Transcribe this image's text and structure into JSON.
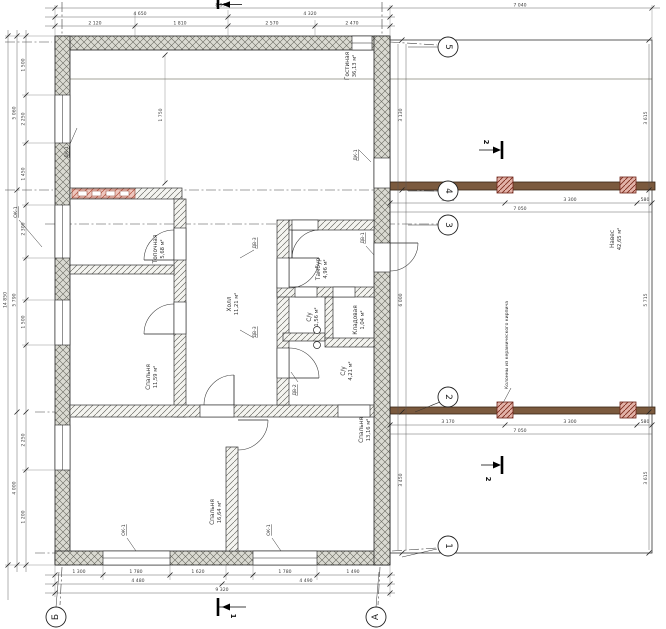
{
  "title": "План дома",
  "rooms": [
    {
      "name": "Гостиная",
      "area": "36,13 м²"
    },
    {
      "name": "Топочная",
      "area": "5,68 м²"
    },
    {
      "name": "Спальня",
      "area": "11,59 м²"
    },
    {
      "name": "Спальня",
      "area": "16,64 м²"
    },
    {
      "name": "Спальня",
      "area": "13,16 м²"
    },
    {
      "name": "Холл",
      "area": "11,21 м²"
    },
    {
      "name": "Тамбур",
      "area": "4,96 м²"
    },
    {
      "name": "С/у",
      "area": "1,56 м²"
    },
    {
      "name": "Кладовая",
      "area": "1,04 м²"
    },
    {
      "name": "С/у",
      "area": "4,21 м²"
    },
    {
      "name": "Навес",
      "area": "42,65 м²"
    }
  ],
  "axes": {
    "a5": "5",
    "a4": "4",
    "a3": "3",
    "a2": "2",
    "a1": "1",
    "ab": "Б",
    "aa": "А"
  },
  "sections": {
    "s1": "1",
    "s2": "2"
  },
  "openings": {
    "window": "ОК-1",
    "ext_door": "ДК-1",
    "int_door_1": "ДВ-1",
    "int_door_2": "ДВ-2",
    "int_door_3": "ДВ-3"
  },
  "notes": {
    "columns": "Колонны из керамического кирпича"
  },
  "colors": {
    "beam": "#7b5a3e",
    "wall_fill": "#dadad2",
    "brick_band": "#eec6bd"
  },
  "dims": {
    "top_overall": "8 970",
    "carport_top": "7 040",
    "top_mid": [
      "4 650",
      "4 320"
    ],
    "top_detail": [
      "2 120",
      "1 810",
      "2 570",
      "2 470"
    ],
    "bottom_detail": [
      "1 300",
      "1 780",
      "1 620",
      "1 780",
      "1 490"
    ],
    "bottom_mid": [
      "4 480",
      "4 490"
    ],
    "bottom_overall": "9 320",
    "left_overall": "14 850",
    "left_mid": [
      "5 060",
      "5 790",
      "4 000"
    ],
    "left_detail": [
      "1 500",
      "2 250",
      "1 450",
      "2 300",
      "1 500",
      "2 250",
      "1 200"
    ],
    "carport_left": [
      "3 130",
      "6 000",
      "3 450"
    ],
    "carport_right": [
      "3 615",
      "5 715",
      "3 615"
    ],
    "carport_bottom": [
      "3 170",
      "3 300",
      "580"
    ],
    "carport_bottom_overall": "7 050",
    "interior_living_height": "1 750"
  }
}
